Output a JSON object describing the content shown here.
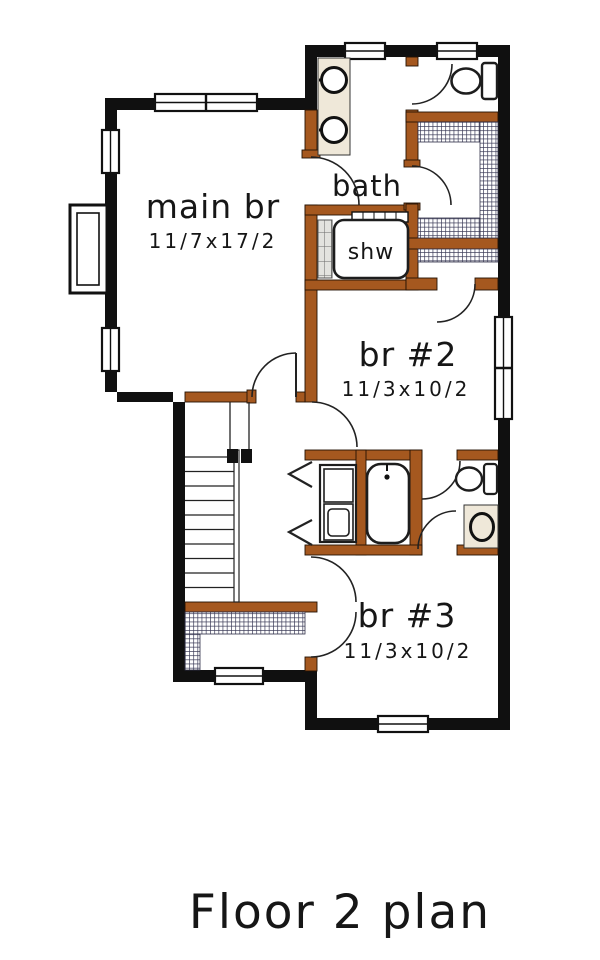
{
  "plan": {
    "title": "Floor 2 plan",
    "rooms": {
      "main_br": {
        "name": "main br",
        "dims": "11/7x17/2"
      },
      "bath": {
        "name": "bath"
      },
      "shower": {
        "name": "shw"
      },
      "br2": {
        "name": "br #2",
        "dims": "11/3x10/2"
      },
      "br3": {
        "name": "br #3",
        "dims": "11/3x10/2"
      }
    },
    "colors": {
      "exterior_wall": "#101010",
      "interior_wall": "#A5581F",
      "fixture_counter": "#EFE8D9",
      "closet_shelving_hatch": "#3B3B58",
      "background": "#FFFFFF"
    }
  }
}
